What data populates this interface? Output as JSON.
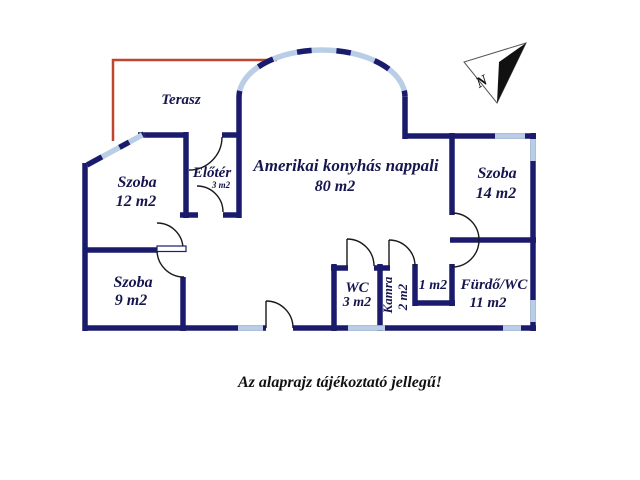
{
  "plan": {
    "disclaimer": "Az alaprajz tájékoztató jellegű!",
    "compass_label": "N",
    "rooms": {
      "terasz": {
        "name": "Terasz"
      },
      "szoba12": {
        "name": "Szoba",
        "area": "12 m2"
      },
      "eloter": {
        "name": "Előtér",
        "area": "3 m2"
      },
      "nappali": {
        "name": "Amerikai konyhás nappali",
        "area": "80 m2"
      },
      "szoba14": {
        "name": "Szoba",
        "area": "14 m2"
      },
      "szoba9": {
        "name": "Szoba",
        "area": "9 m2"
      },
      "wc": {
        "name": "WC",
        "area": "3 m2"
      },
      "kamra": {
        "name": "Kamra",
        "area": "2 m2"
      },
      "storage1": {
        "area": "1 m2"
      },
      "furdo": {
        "name": "Fürdő/WC",
        "area": "11 m2"
      }
    },
    "colors": {
      "wall": "#1a1b6c",
      "window": "#b9cee6",
      "terrace": "#c0452f",
      "door": "#1a1a1a",
      "label_text": "#16164e",
      "disclaimer_text": "#111111",
      "compass": "#111111"
    }
  }
}
